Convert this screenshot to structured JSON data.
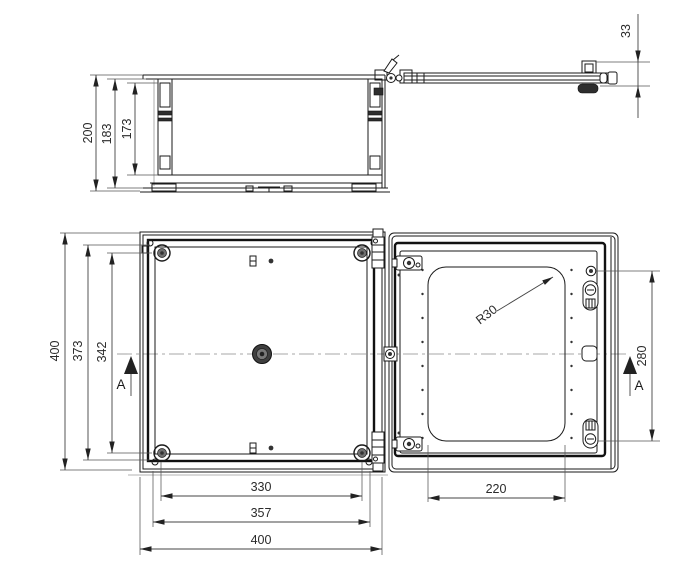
{
  "drawing": {
    "side_view": {
      "dim_overall_height": "200",
      "dim_inner_height": "183",
      "dim_depth": "173",
      "dim_lid_height": "33"
    },
    "back_view": {
      "dim_overall_height": "400",
      "dim_body_height": "373",
      "dim_screw_spacing_v": "342",
      "dim_screw_spacing_h": "330",
      "dim_body_width": "357",
      "dim_overall_width": "400",
      "section_label": "A"
    },
    "door_view": {
      "dim_window_width": "220",
      "dim_latch_spacing": "280",
      "radius_label": "R30",
      "section_label": "A"
    },
    "colors": {
      "line": "#1a1a1a",
      "dim_line": "#444444",
      "dim_text": "#2b2b2b",
      "light_line": "#999999",
      "background": "#ffffff"
    }
  }
}
